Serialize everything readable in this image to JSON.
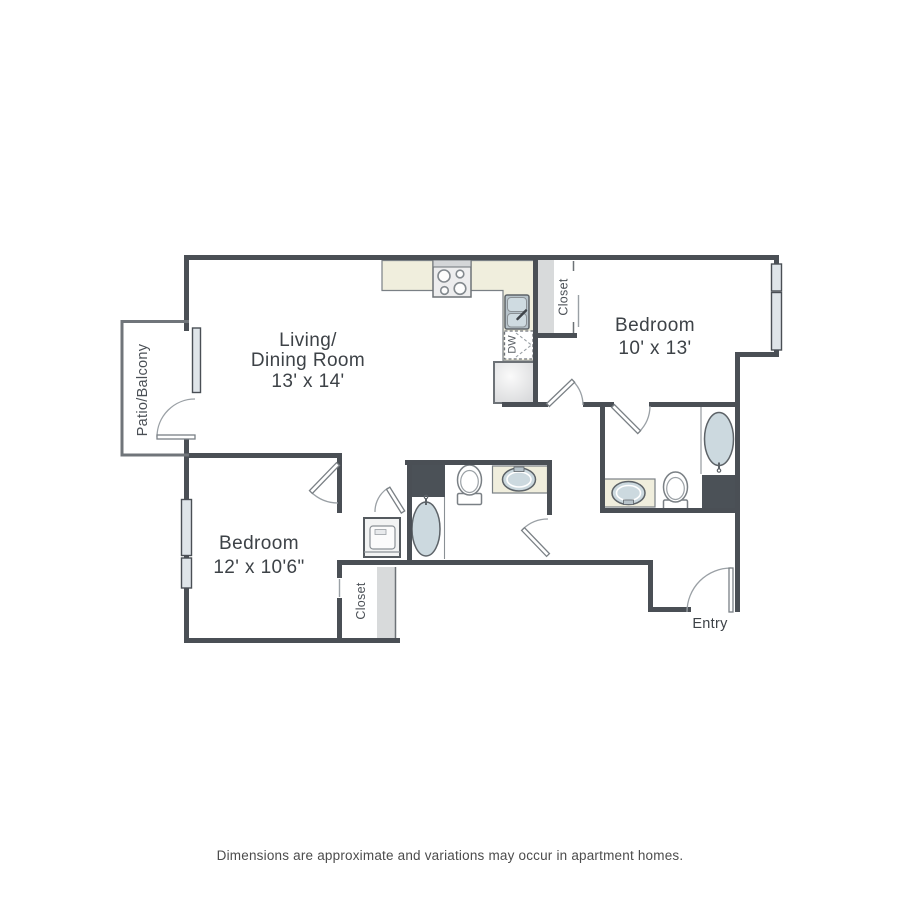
{
  "colors": {
    "wall": "#4a4f55",
    "wall_light": "#70757a",
    "line": "#8a9095",
    "arc": "#9aa0a5",
    "counter": "#f0eedd",
    "fixture": "#ccd9df",
    "dark_block": "#4b5157",
    "closet_band": "#d8dadb",
    "window_fill": "#dfe5e9",
    "appliance": "#ededee",
    "text": "#3d4247",
    "footer_text": "#4c4c4c",
    "background": "#ffffff"
  },
  "floorplan": {
    "rooms": [
      {
        "id": "living-dining-room",
        "name_lines": [
          "Living/",
          "Dining Room"
        ],
        "dimensions": "13' x 14'"
      },
      {
        "id": "bedroom-1",
        "name": "Bedroom",
        "dimensions": "10' x 13'"
      },
      {
        "id": "bedroom-2",
        "name": "Bedroom",
        "dimensions": "12' x 10'6\""
      },
      {
        "id": "patio-balcony",
        "name": "Patio/Balcony"
      },
      {
        "id": "entry",
        "name": "Entry"
      },
      {
        "id": "closet-kitchen",
        "name": "Closet"
      },
      {
        "id": "closet-bedroom-2",
        "name": "Closet"
      }
    ],
    "appliances": {
      "dishwasher_label": "DW"
    },
    "fixture_icons": [
      "stove-icon",
      "kitchen-sink-icon",
      "dishwasher-icon",
      "refrigerator-icon",
      "washer-icon",
      "bathtub-icon",
      "toilet-icon",
      "vanity-sink-icon",
      "door-swing-icon",
      "window-icon"
    ]
  },
  "footer": {
    "disclaimer": "Dimensions are approximate and variations may occur in apartment homes."
  }
}
